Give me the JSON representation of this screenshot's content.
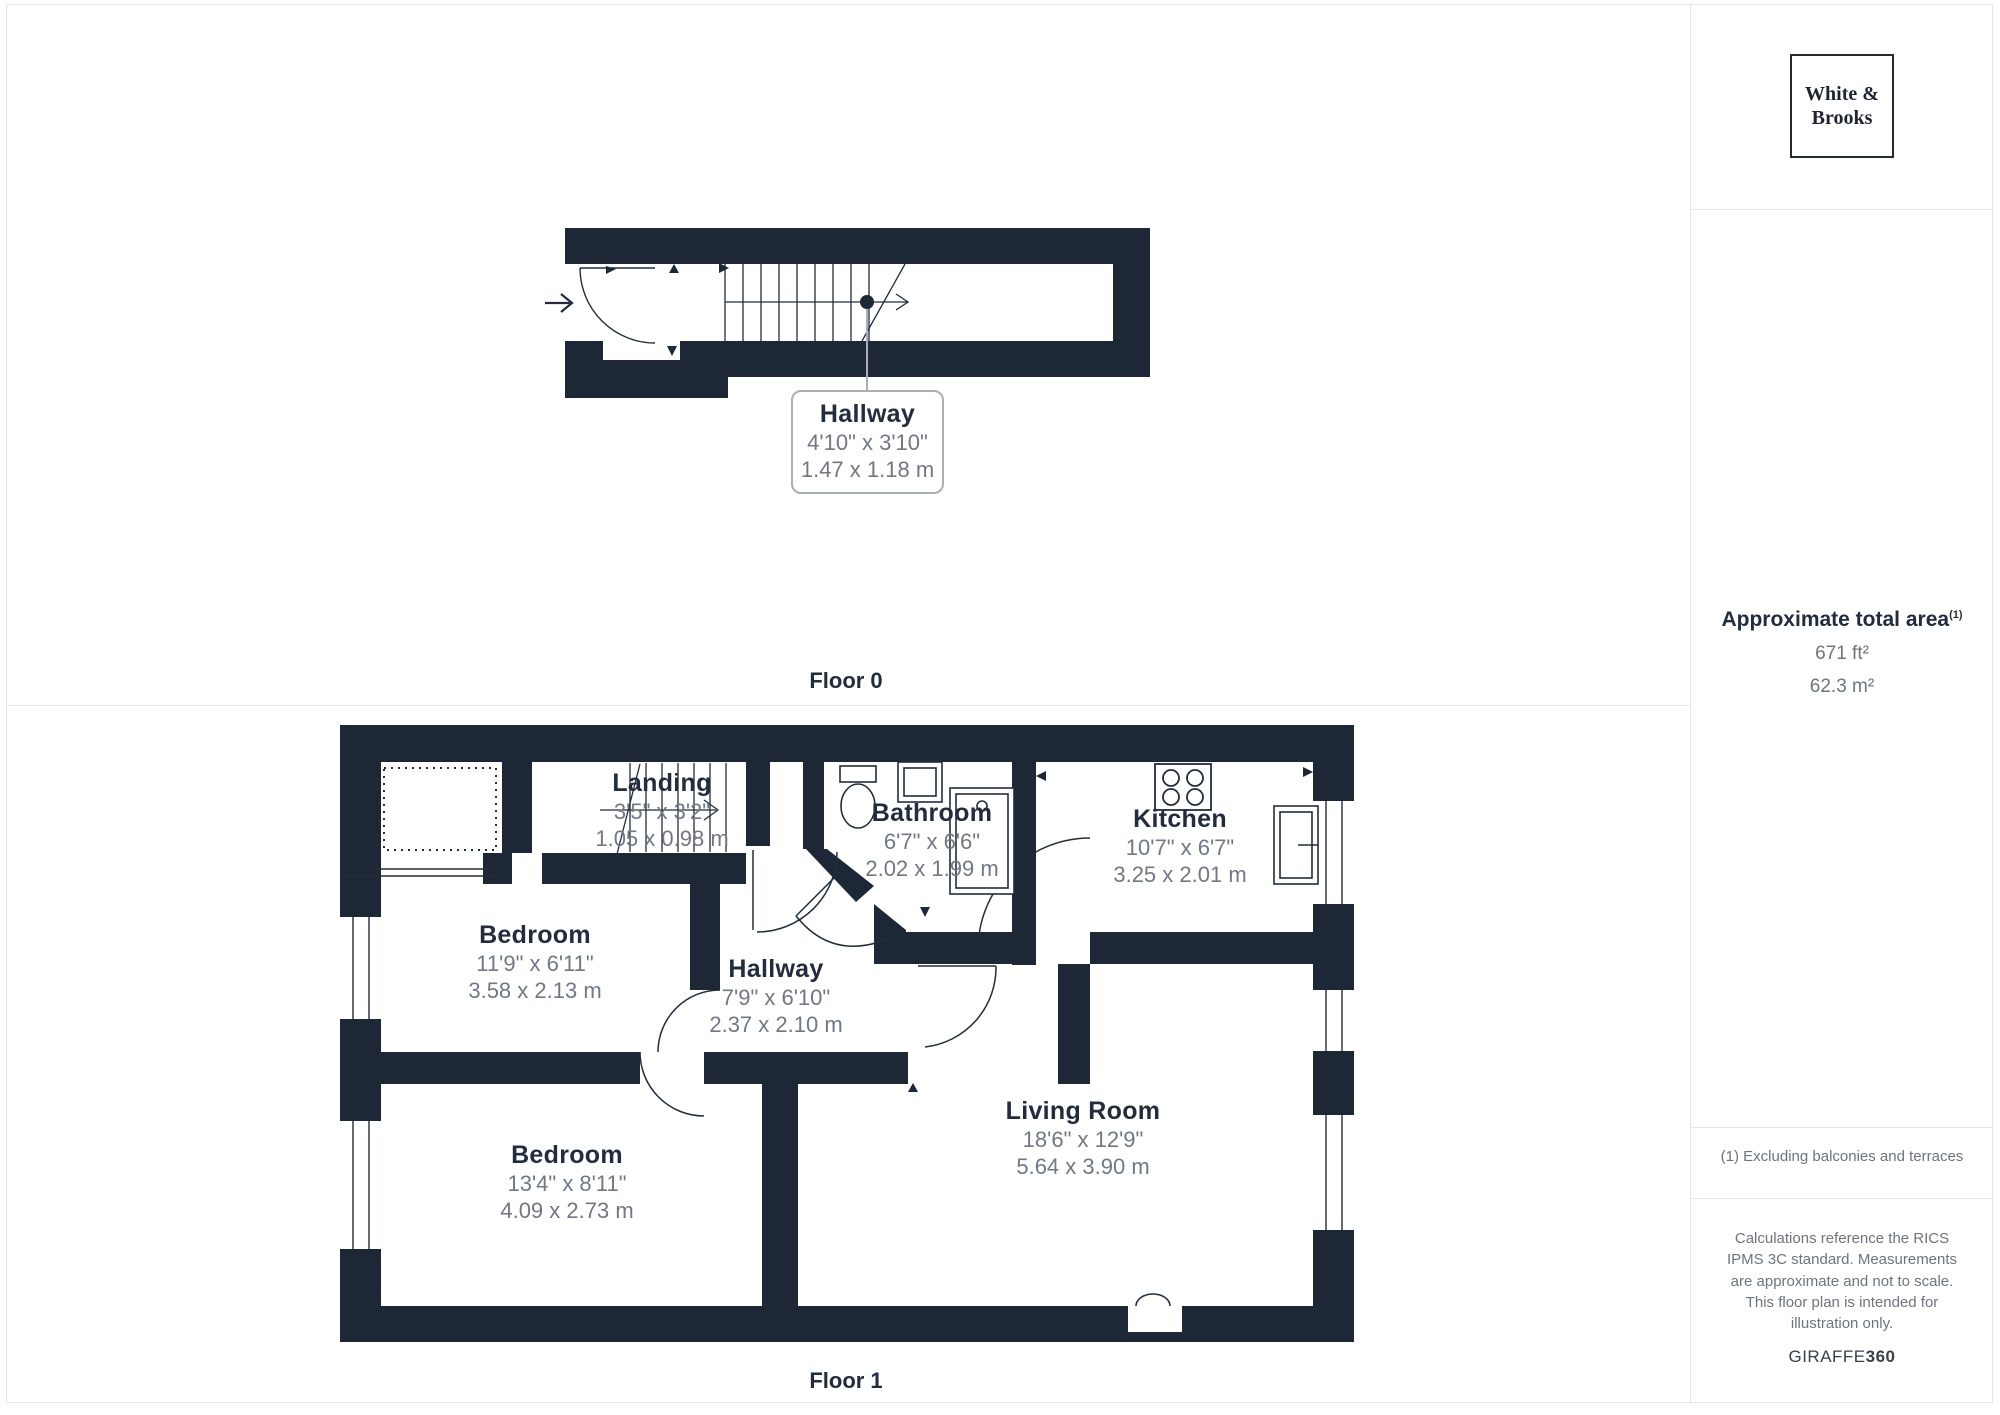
{
  "branding": {
    "logo_line1": "White &",
    "logo_line2": "Brooks",
    "provider_name": "GIRAFFE",
    "provider_suffix": "360"
  },
  "summary": {
    "title": "Approximate total area",
    "title_note_marker": "(1)",
    "area_imperial": "671 ft²",
    "area_metric": "62.3 m²"
  },
  "footnotes": {
    "exclusion_note": "(1) Excluding balconies and terraces",
    "disclaimer": "Calculations reference the RICS IPMS 3C standard. Measurements are approximate and not to scale. This floor plan is intended for illustration only."
  },
  "floor0": {
    "caption": "Floor 0",
    "rooms": [
      {
        "name": "Hallway",
        "size_imperial": "4'10\" x 3'10\"",
        "size_metric": "1.47 x 1.18 m"
      }
    ]
  },
  "floor1": {
    "caption": "Floor 1",
    "rooms": [
      {
        "name": "Landing",
        "size_imperial": "3'5\" x 3'2\"",
        "size_metric": "1.05 x 0.98 m"
      },
      {
        "name": "Bathroom",
        "size_imperial": "6'7\" x 6'6\"",
        "size_metric": "2.02 x 1.99 m"
      },
      {
        "name": "Kitchen",
        "size_imperial": "10'7\" x 6'7\"",
        "size_metric": "3.25 x 2.01 m"
      },
      {
        "name": "Bedroom",
        "size_imperial": "11'9\" x 6'11\"",
        "size_metric": "3.58 x 2.13 m"
      },
      {
        "name": "Hallway",
        "size_imperial": "7'9\" x 6'10\"",
        "size_metric": "2.37 x 2.10 m"
      },
      {
        "name": "Bedroom",
        "size_imperial": "13'4\" x 8'11\"",
        "size_metric": "4.09 x 2.73 m"
      },
      {
        "name": "Living Room",
        "size_imperial": "18'6\" x 12'9\"",
        "size_metric": "5.64 x 3.90 m"
      }
    ]
  },
  "colors": {
    "wall": "#1e2735",
    "room_name": "#222c3c",
    "dimension_text": "#717883",
    "divider": "#e4e5e6",
    "callout_border": "#a9aeb7"
  }
}
